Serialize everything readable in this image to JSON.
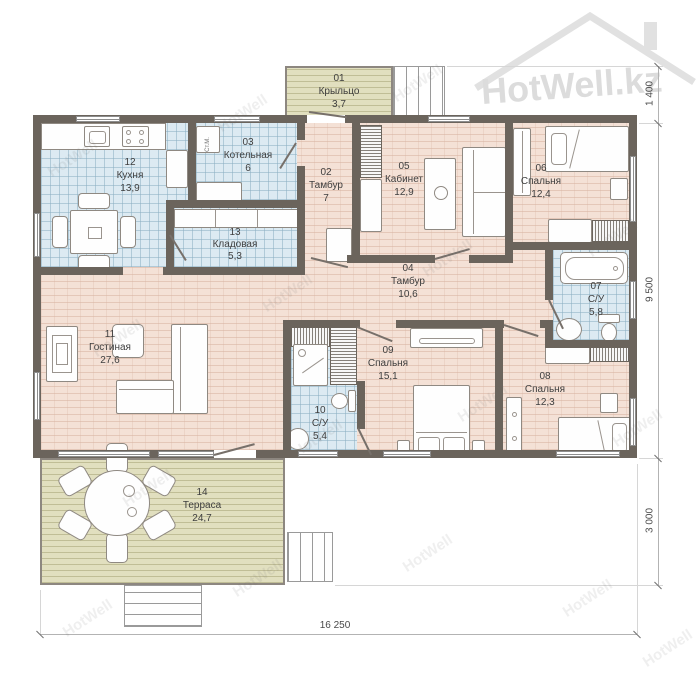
{
  "watermark": {
    "text": "HotWell",
    "logo_text": "HotWell.kz"
  },
  "rooms": [
    {
      "num": "01",
      "name": "Крыльцо",
      "area": "3,7"
    },
    {
      "num": "02",
      "name": "Тамбур",
      "area": "7"
    },
    {
      "num": "03",
      "name": "Котельная",
      "area": "6"
    },
    {
      "num": "04",
      "name": "Тамбур",
      "area": "10,6"
    },
    {
      "num": "05",
      "name": "Кабинет",
      "area": "12,9"
    },
    {
      "num": "06",
      "name": "Спальня",
      "area": "12,4"
    },
    {
      "num": "07",
      "name": "С/У",
      "area": "5,8"
    },
    {
      "num": "08",
      "name": "Спальня",
      "area": "12,3"
    },
    {
      "num": "09",
      "name": "Спальня",
      "area": "15,1"
    },
    {
      "num": "10",
      "name": "С/У",
      "area": "5,4"
    },
    {
      "num": "11",
      "name": "Гостиная",
      "area": "27,6"
    },
    {
      "num": "12",
      "name": "Кухня",
      "area": "13,9"
    },
    {
      "num": "13",
      "name": "Кладовая",
      "area": "5,3"
    },
    {
      "num": "14",
      "name": "Терраса",
      "area": "24,7"
    }
  ],
  "dimensions": {
    "right_top": "1 400",
    "right_middle": "9 500",
    "right_bottom": "3 000",
    "bottom": "16 250"
  },
  "appliances": {
    "washing_machine": "Ст.М."
  },
  "colors": {
    "wall": "#6b645c",
    "floor_wood": "#f4e1d6",
    "floor_tile": "#dceaf2",
    "floor_deck": "#e1dfbf"
  }
}
